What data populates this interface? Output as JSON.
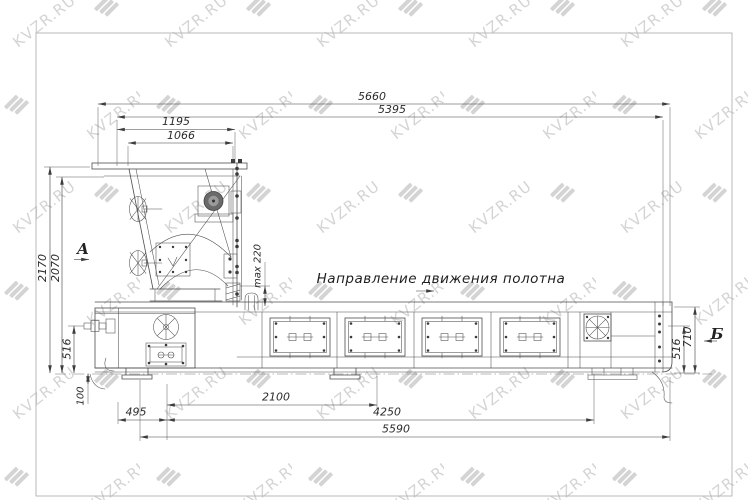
{
  "watermark": {
    "text": "KVZR.RU"
  },
  "annotation": {
    "direction_label": "Направление движения полотна"
  },
  "section_markers": {
    "a_label": "А",
    "b_label": "Б"
  },
  "dims": {
    "d5660": "5660",
    "d5395": "5395",
    "d1195": "1195",
    "d1066": "1066",
    "d2170": "2170",
    "d2070": "2070",
    "d516L": "516",
    "dmax": "max 220",
    "d100": "100",
    "d495": "495",
    "d2100": "2100",
    "d4250": "4250",
    "d5590": "5590",
    "d710": "710",
    "d516R": "516"
  },
  "colors": {
    "background": "#ffffff",
    "line": "#4d4d4d",
    "dimension": "#3d3d3d",
    "sheet_frame": "#b3b3b3",
    "watermark": "#c4c4c4"
  }
}
